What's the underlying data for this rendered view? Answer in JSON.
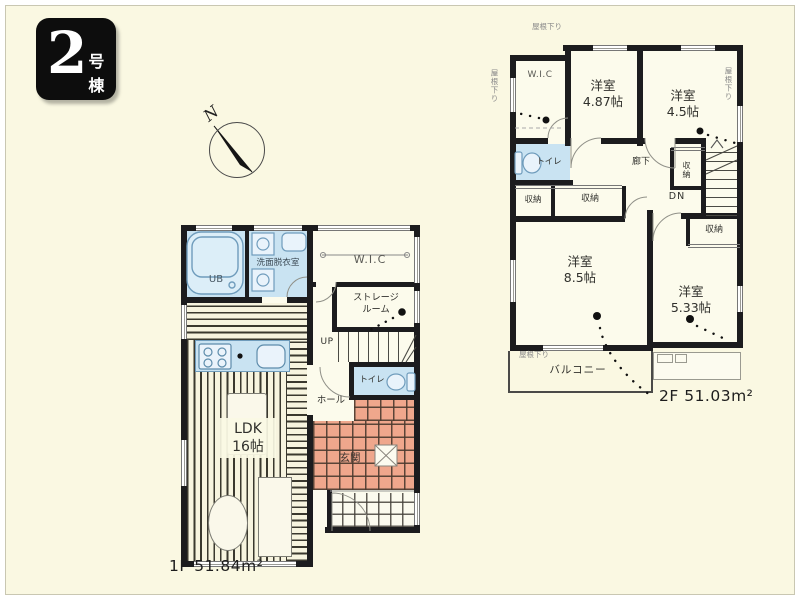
{
  "badge": {
    "number": "2",
    "suffix": "号棟"
  },
  "compass": {
    "north": "N"
  },
  "floor1": {
    "area_label": "1F 51.84m²",
    "ub": "UB",
    "washroom": "洗面脱衣室",
    "wic": "W.I.C",
    "storage": "ストレージ\nルーム",
    "up": "UP",
    "toilet": "トイレ",
    "hall": "ホール",
    "ldk": "LDK\n16帖",
    "entrance": "玄関"
  },
  "floor2": {
    "area_label": "2F 51.03m²",
    "wic": "W.I.C",
    "room_487": "洋室\n4.87帖",
    "room_45": "洋室\n4.5帖",
    "toilet": "トイレ",
    "hallway": "廊下",
    "closet_left": "収納",
    "closet_mid": "収納",
    "closet_right": "収納",
    "closet_bottom": "収納",
    "dn": "DN",
    "room_85": "洋室\n8.5帖",
    "room_533": "洋室\n5.33帖",
    "balcony": "バルコニー",
    "roof_note_top": "屋根下り",
    "roof_note_right": "屋根下り",
    "roof_note_left": "屋根下り",
    "roof_note_balcony": "屋根下り"
  },
  "colors": {
    "background": "#FAF8E2",
    "wall": "#1C1C1E",
    "water_rooms": "#C9E3F2",
    "entrance_tile": "#EFA78C",
    "badge_background": "#0D0D0D"
  }
}
